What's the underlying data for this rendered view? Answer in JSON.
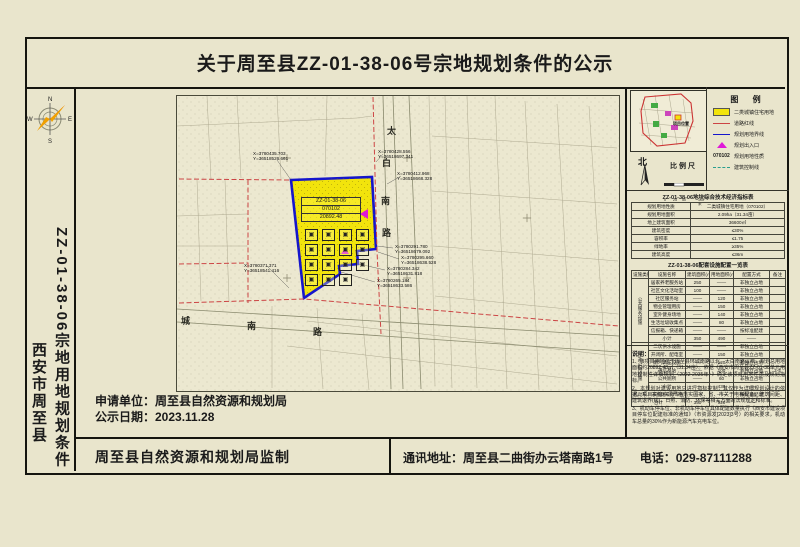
{
  "title": "关于周至县ZZ-01-38-06号宗地规划条件的公示",
  "sidebar": {
    "project_label": "ZZ-01-38-06宗地用地规划条件",
    "city_label": "西安市周至县",
    "compass": {
      "n": "N",
      "s": "S",
      "e": "E",
      "w": "W"
    }
  },
  "colors": {
    "parcel_fill": "#f2e40c",
    "parcel_border": "#1515cc",
    "road_red_line": "#cc4444",
    "entrance_magenta": "#e018d8",
    "background": "#e9e5cc"
  },
  "map": {
    "parcel": {
      "code": "ZZ-01-38-06",
      "use_code": "070102",
      "area": "20892.48"
    },
    "roads": {
      "east_road": [
        "太",
        "白",
        "南",
        "路"
      ],
      "south_road": [
        "城",
        "南",
        "路"
      ]
    },
    "symbols": [
      "▣",
      "▣",
      "▣",
      "▣",
      "▣",
      "▣",
      "▣",
      "▣",
      "▣",
      "▣",
      "▣",
      "▣",
      "▣",
      "▣",
      "▣"
    ],
    "coordinate_callouts": [
      {
        "x": "X=3780435.703",
        "y": "Y=36518526.661",
        "left": 252,
        "top": 150
      },
      {
        "x": "X=3780428.556",
        "y": "Y=36518697.341",
        "left": 377,
        "top": 148
      },
      {
        "x": "X=3780412.968",
        "y": "Y=36518668.328",
        "left": 396,
        "top": 170
      },
      {
        "x": "X=3780371.371",
        "y": "Y=36518541.416",
        "left": 243,
        "top": 262
      },
      {
        "x": "X=3780291.780",
        "y": "Y=36518679.092",
        "left": 394,
        "top": 243
      },
      {
        "x": "X=3780295.660",
        "y": "Y=36518638.528",
        "left": 400,
        "top": 254
      },
      {
        "x": "X=3780284.342",
        "y": "Y=36518631.818",
        "left": 386,
        "top": 265
      },
      {
        "x": "X=3780265.184",
        "y": "Y=36518633.586",
        "left": 376,
        "top": 277
      }
    ]
  },
  "inset": {
    "label": "项目位置",
    "north_label": "北",
    "scale_label": "比例尺",
    "scale_ticks": [
      "0",
      "25",
      "50",
      "100米"
    ]
  },
  "legend": {
    "title": "图  例",
    "items": [
      {
        "swatch": "yellow-fill",
        "label": "二类城镇住宅用地"
      },
      {
        "swatch": "red-line",
        "label": "道路红线"
      },
      {
        "swatch": "blue-line",
        "label": "规划用地界线"
      },
      {
        "swatch": "magenta-triangle",
        "label": "规划出入口"
      },
      {
        "swatch": "code-text",
        "code": "070102",
        "label": "规划用地性质"
      },
      {
        "swatch": "dashed-line",
        "label": "建筑控制线"
      }
    ]
  },
  "indicator_table": {
    "title": "ZZ-01-38-06地块综合技术经济指标表",
    "rows": [
      {
        "label": "规划用地性质",
        "value": "二类城镇住宅用地（070102）"
      },
      {
        "label": "规划用地面积",
        "value": "2.09ha（31.34亩）"
      },
      {
        "label": "地上建筑面积",
        "value": "36600㎡"
      },
      {
        "label": "建筑密度",
        "value": "≤30%"
      },
      {
        "label": "容积率",
        "value": "≤1.75"
      },
      {
        "label": "绿地率",
        "value": "≥35%"
      },
      {
        "label": "建筑高度",
        "value": "≤36m"
      }
    ]
  },
  "facility_table": {
    "title": "ZZ-01-38-06配套设施配置一览表",
    "columns": [
      "设施类别",
      "设施名称",
      "建筑面积(㎡)",
      "用地面积(㎡)",
      "配置方式",
      "备注"
    ],
    "rows": [
      {
        "cat": "公共服务设施",
        "span": 8,
        "name": "居家养老服务站",
        "b": "250",
        "l": "——",
        "mode": "非独立占地",
        "note": ""
      },
      {
        "name": "社区文化活动室",
        "b": "100",
        "l": "——",
        "mode": "非独立占地",
        "note": ""
      },
      {
        "name": "社区服务站",
        "b": "——",
        "l": "120",
        "mode": "非独立占地",
        "note": ""
      },
      {
        "name": "物业管理用房",
        "b": "——",
        "l": "150",
        "mode": "非独立占地",
        "note": ""
      },
      {
        "name": "室外健身场地",
        "b": "——",
        "l": "140",
        "mode": "非独立占地",
        "note": ""
      },
      {
        "name": "生活垃圾收集点",
        "b": "——",
        "l": "80",
        "mode": "非独立占地",
        "note": ""
      },
      {
        "name": "信报箱、快递箱",
        "b": "——",
        "l": "——",
        "mode": "按标准配建",
        "note": ""
      },
      {
        "name": "小计",
        "b": "350",
        "l": "490",
        "mode": "——",
        "note": "",
        "sub": true
      },
      {
        "cat": "市政公用设施",
        "span": 6,
        "name": "二次供水设施",
        "b": "——",
        "l": "——",
        "mode": "非独立占地",
        "note": ""
      },
      {
        "name": "开闭所、配电室",
        "b": "——",
        "l": "150",
        "mode": "非独立占地",
        "note": ""
      },
      {
        "name": "燃气调压设施",
        "b": "——",
        "l": "120",
        "mode": "非独立占地",
        "note": ""
      },
      {
        "name": "通信基站",
        "b": "——",
        "l": "100",
        "mode": "非独立占地",
        "note": "2-4"
      },
      {
        "name": "公共厕所",
        "b": "——",
        "l": "60",
        "mode": "非独立占地",
        "note": ""
      },
      {
        "name": "小计",
        "b": "——",
        "l": "430",
        "mode": "——",
        "note": "",
        "sub": true
      },
      {
        "name": "机动车、非机动车停车位",
        "b": "——",
        "l": "——",
        "mode": "按标准配建",
        "note": "",
        "wide": true
      },
      {
        "name": "合计",
        "b": "350",
        "l": "920",
        "mode": "——",
        "note": "",
        "wide": true,
        "sub": true
      }
    ]
  },
  "notes": {
    "title": "说明：",
    "paragraphs": [
      "1、该项目用地位于周至县环城南路以北、太白南路以西，规划总用地面积约20892.48㎡（31.34亩）。依据《西安市周至县ZZ-01-38单元用地控制性详细规划（2022-2035年）》确定该项目用地性质及规划指标。",
      "2、本规划对建设用地只进行指标控制，其仅作为详细规划设计的依据。项目实施中须严格落实国家、省、市关于电梯配备、建筑间距、建筑退界(线)、日照、消防、环保等相关方面的法规规定和标准。",
      "3、机动车停车位、非机动车停车位具体配建数量执行《西安市建设项目停车位配建标准的通知》（市资源发[2023]3号）的相关要求，机动车总量的30%作为新能源汽车充电车位。"
    ]
  },
  "application": {
    "applicant_line": "申请单位：周至县自然资源和规划局",
    "date_line": "公示日期：2023.11.28"
  },
  "footer": {
    "producer": "周至县自然资源和规划局监制",
    "address": "通讯地址：周至县二曲街办云塔南路1号",
    "phone": "电话：029-87111288"
  }
}
